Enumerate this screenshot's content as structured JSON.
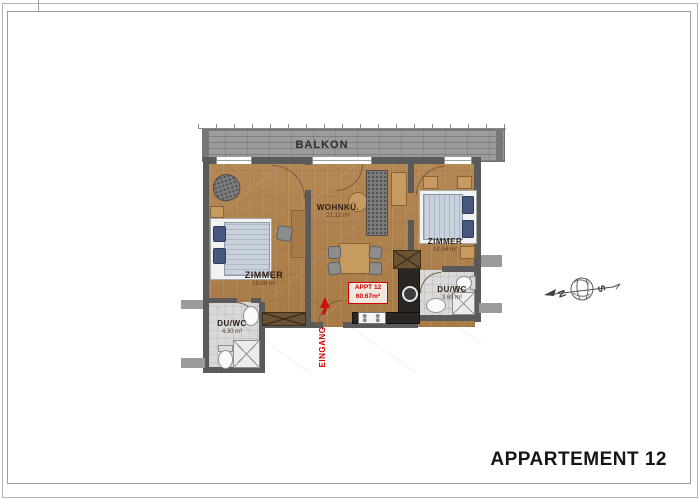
{
  "sheet": {
    "title": "APPARTEMENT 12"
  },
  "plan": {
    "balcony": {
      "label": "BALKON"
    },
    "rooms": {
      "zimmer_left": {
        "name": "ZIMMER",
        "area": "18.09 m²"
      },
      "wohnkueche": {
        "name": "WOHNKÜ.",
        "area": "21.12 m²"
      },
      "zimmer_right": {
        "name": "ZIMMER",
        "area": "12.34 m²"
      },
      "bath_left": {
        "name": "DU/WC",
        "area": "4.30 m²"
      },
      "bath_right": {
        "name": "DU/WC",
        "area": "3.69 m²"
      }
    },
    "apartment_badge": {
      "line1": "APPT 12",
      "line2": "60.67m²"
    },
    "entrance": {
      "label": "EINGANG"
    },
    "compass": {
      "north": "N",
      "south": "S"
    }
  },
  "colors": {
    "accent_red": "#cc0000",
    "wood_floor": "#b08049",
    "wall_gray": "#5a5a5a",
    "balcony_gray": "#9c9c9c",
    "bath_floor": "#d9d9d9",
    "bed_blue": "#c9d2dc",
    "pillow_blue": "#46587e",
    "counter_dark": "#2a2622"
  }
}
